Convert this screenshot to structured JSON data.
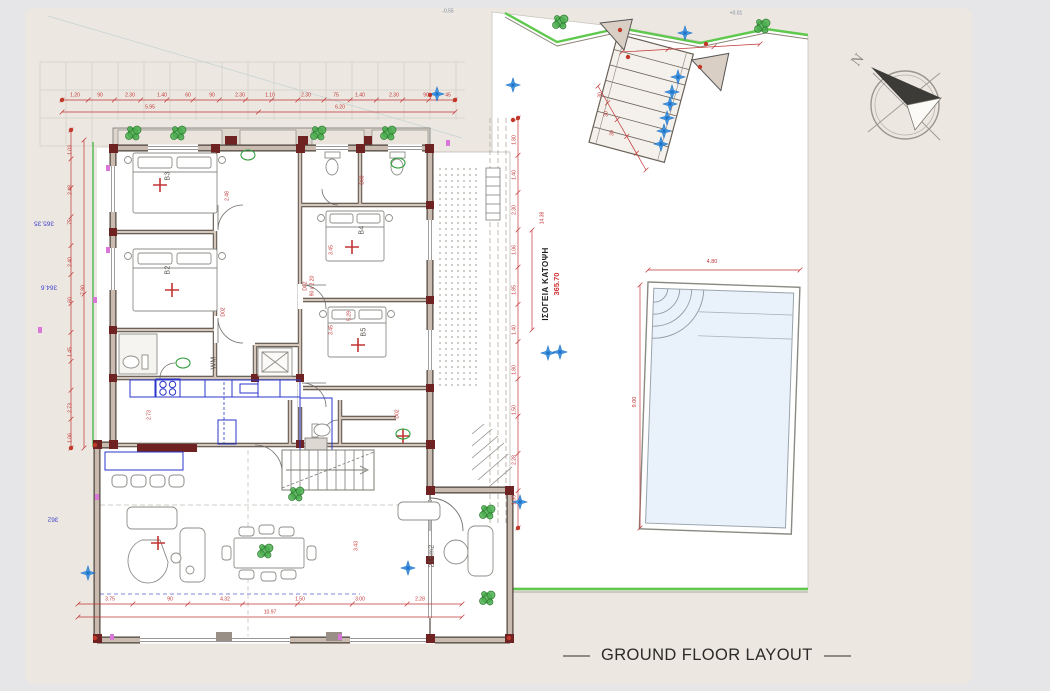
{
  "title": {
    "text": "GROUND FLOOR LAYOUT"
  },
  "plan_caption": {
    "greek": "ΙΣΟΓΕΙΑ ΚΑΤΟΨΗ",
    "elevation": "365.70"
  },
  "compass": {
    "label": "N"
  },
  "pool": {
    "width": "4.80",
    "depth": "9.00"
  },
  "room_labels": [
    {
      "t": "B3",
      "x": 168,
      "y": 176
    },
    {
      "t": "B2",
      "x": 168,
      "y": 270
    },
    {
      "t": "B4",
      "x": 362,
      "y": 230
    },
    {
      "t": "B5",
      "x": 364,
      "y": 332
    },
    {
      "t": "WM",
      "x": 214,
      "y": 363
    },
    {
      "t": "216m2",
      "x": 432,
      "y": 556
    }
  ],
  "elevation_labels": [
    {
      "t": "365.35",
      "x": 44,
      "y": 222
    },
    {
      "t": "364.6",
      "x": 49,
      "y": 286
    },
    {
      "t": "362",
      "x": 53,
      "y": 518
    }
  ],
  "misc_labels": [
    {
      "t": "-0.55",
      "x": 448,
      "y": 12
    },
    {
      "t": "+0.01",
      "x": 736,
      "y": 14
    }
  ],
  "dim_labels": [
    {
      "t": "1.20",
      "x": 75,
      "y": 96
    },
    {
      "t": "90",
      "x": 100,
      "y": 96
    },
    {
      "t": "2.30",
      "x": 130,
      "y": 96
    },
    {
      "t": "1.40",
      "x": 162,
      "y": 96
    },
    {
      "t": "60",
      "x": 188,
      "y": 96
    },
    {
      "t": "90",
      "x": 212,
      "y": 96
    },
    {
      "t": "2.30",
      "x": 240,
      "y": 96
    },
    {
      "t": "1.10",
      "x": 270,
      "y": 96
    },
    {
      "t": "2.30",
      "x": 306,
      "y": 96
    },
    {
      "t": "75",
      "x": 336,
      "y": 96
    },
    {
      "t": "1.40",
      "x": 360,
      "y": 96
    },
    {
      "t": "2.30",
      "x": 394,
      "y": 96
    },
    {
      "t": "90",
      "x": 426,
      "y": 96
    },
    {
      "t": "45",
      "x": 448,
      "y": 96
    },
    {
      "t": "5.95",
      "x": 150,
      "y": 108
    },
    {
      "t": "6.20",
      "x": 340,
      "y": 108
    },
    {
      "t": "1.03",
      "x": 71,
      "y": 150,
      "r": 1
    },
    {
      "t": "2.48",
      "x": 71,
      "y": 190,
      "r": 1
    },
    {
      "t": "75",
      "x": 71,
      "y": 222,
      "r": 1
    },
    {
      "t": "2.40",
      "x": 71,
      "y": 262,
      "r": 1
    },
    {
      "t": "60",
      "x": 71,
      "y": 300,
      "r": 1
    },
    {
      "t": "1.45",
      "x": 71,
      "y": 352,
      "r": 1
    },
    {
      "t": "2.73",
      "x": 71,
      "y": 408,
      "r": 1
    },
    {
      "t": "1.06",
      "x": 71,
      "y": 438,
      "r": 1
    },
    {
      "t": "7.90",
      "x": 84,
      "y": 290,
      "r": 1
    },
    {
      "t": "1.80",
      "x": 515,
      "y": 140,
      "r": 1
    },
    {
      "t": "1.40",
      "x": 515,
      "y": 175,
      "r": 1
    },
    {
      "t": "2.30",
      "x": 515,
      "y": 210,
      "r": 1
    },
    {
      "t": "1.06",
      "x": 515,
      "y": 250,
      "r": 1
    },
    {
      "t": "1.85",
      "x": 515,
      "y": 290,
      "r": 1
    },
    {
      "t": "1.40",
      "x": 515,
      "y": 330,
      "r": 1
    },
    {
      "t": "1.80",
      "x": 515,
      "y": 370,
      "r": 1
    },
    {
      "t": "1.50",
      "x": 515,
      "y": 410,
      "r": 1
    },
    {
      "t": "2.28",
      "x": 515,
      "y": 460,
      "r": 1
    },
    {
      "t": "1.35",
      "x": 515,
      "y": 500,
      "r": 1
    },
    {
      "t": "3.75",
      "x": 110,
      "y": 600
    },
    {
      "t": "90",
      "x": 170,
      "y": 600
    },
    {
      "t": "4.32",
      "x": 225,
      "y": 600
    },
    {
      "t": "1.50",
      "x": 300,
      "y": 600
    },
    {
      "t": "3.00",
      "x": 360,
      "y": 600
    },
    {
      "t": "2.28",
      "x": 420,
      "y": 600
    },
    {
      "t": "10.97",
      "x": 270,
      "y": 613
    },
    {
      "t": "2.48",
      "x": 228,
      "y": 196,
      "r": 1
    },
    {
      "t": "3.45",
      "x": 332,
      "y": 250,
      "r": 1
    },
    {
      "t": "3.45",
      "x": 332,
      "y": 330,
      "r": 1
    },
    {
      "t": "5.29",
      "x": 350,
      "y": 316,
      "r": 1
    },
    {
      "t": "2.73",
      "x": 150,
      "y": 415,
      "r": 1
    },
    {
      "t": "3.43",
      "x": 357,
      "y": 546,
      "r": 1
    },
    {
      "t": "D02",
      "x": 306,
      "y": 286,
      "r": 1
    },
    {
      "t": "90 x 2.20",
      "x": 313,
      "y": 286,
      "r": 1
    },
    {
      "t": "D02",
      "x": 224,
      "y": 312,
      "r": 1
    },
    {
      "t": "D02",
      "x": 398,
      "y": 414,
      "r": 1
    },
    {
      "t": "D03",
      "x": 363,
      "y": 180,
      "r": 1
    },
    {
      "t": "30",
      "x": 601,
      "y": 95,
      "r": 1
    },
    {
      "t": "30",
      "x": 607,
      "y": 114,
      "r": 1
    },
    {
      "t": "30",
      "x": 613,
      "y": 133,
      "r": 1
    },
    {
      "t": "14.38",
      "x": 543,
      "y": 218,
      "r": 1
    }
  ],
  "markers": {
    "stars": [
      [
        685,
        33
      ],
      [
        678,
        77
      ],
      [
        672,
        92
      ],
      [
        670,
        104
      ],
      [
        667,
        118
      ],
      [
        664,
        131
      ],
      [
        661,
        144
      ],
      [
        437,
        94
      ],
      [
        513,
        85
      ],
      [
        548,
        353
      ],
      [
        560,
        352
      ],
      [
        408,
        568
      ],
      [
        88,
        573
      ],
      [
        520,
        502
      ]
    ],
    "crosses": [
      [
        160,
        185
      ],
      [
        172,
        290
      ],
      [
        352,
        247
      ],
      [
        358,
        345
      ],
      [
        158,
        543
      ],
      [
        403,
        436
      ]
    ],
    "plants": [
      [
        133,
        133
      ],
      [
        178,
        133
      ],
      [
        318,
        133
      ],
      [
        388,
        133
      ],
      [
        296,
        494
      ],
      [
        487,
        512
      ],
      [
        487,
        598
      ],
      [
        265,
        551
      ],
      [
        560,
        22
      ],
      [
        762,
        26
      ]
    ],
    "sink_ovals": [
      [
        248,
        155
      ],
      [
        398,
        163
      ],
      [
        183,
        363
      ],
      [
        403,
        434
      ]
    ],
    "red_dots": [
      [
        628,
        57
      ],
      [
        700,
        67
      ],
      [
        95,
        638
      ],
      [
        509,
        638
      ],
      [
        430,
        95
      ],
      [
        513,
        120
      ],
      [
        95,
        445
      ],
      [
        620,
        30
      ],
      [
        706,
        44
      ],
      [
        62,
        100
      ],
      [
        455,
        100
      ],
      [
        71,
        130
      ],
      [
        71,
        448
      ],
      [
        518,
        118
      ],
      [
        518,
        528
      ]
    ],
    "magenta_ticks": [
      [
        40,
        330
      ],
      [
        95,
        300
      ],
      [
        97,
        497
      ],
      [
        112,
        637
      ],
      [
        340,
        637
      ],
      [
        448,
        143
      ],
      [
        108,
        168
      ],
      [
        108,
        250
      ]
    ]
  },
  "colors": {
    "sheet": "#ece8e1",
    "canvas": "#e6e5e7",
    "dimension_red": "#c23434",
    "wall_dark": "#4a4038",
    "wall_fill": "#c9bbb0",
    "maroon": "#6e2222",
    "boundary_green": "#5fc94e",
    "plant_green": "#2f7d32",
    "kitchen_blue": "#2a35c8",
    "star_blue": "#4aa0e8",
    "pool_fill": "#e9f2fa",
    "magenta": "#d977d9",
    "elevation_blue": "#4646cc",
    "title_ink": "#2b2a28"
  }
}
